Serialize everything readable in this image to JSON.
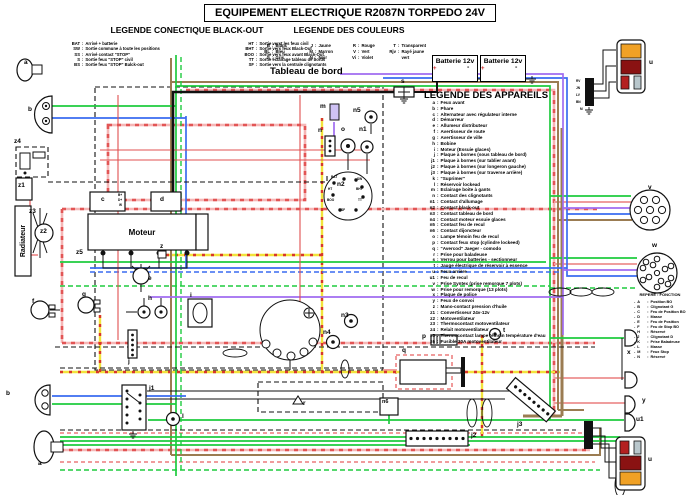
{
  "title": "EQUIPEMENT ELECTRIQUE R2087N TORPEDO 24V",
  "ui": {
    "sep": ":",
    "bullet": "-"
  },
  "colors": {
    "green": "#1ecb3e",
    "pink": "#f2a0a0",
    "red": "#e25555",
    "blue": "#3a6cf0",
    "yellow": "#f2e33c",
    "brown": "#9b7c52",
    "violet": "#a06cf0",
    "black": "#111111",
    "orange": "#f0a125",
    "dark_red": "#8a1212"
  },
  "legend_connectique": {
    "title": "LEGENDE CONECTIQUE BLACK-OUT",
    "col1": [
      {
        "c": "BAT",
        "d": "Arrivé + batterie"
      },
      {
        "c": "SW",
        "d": "Sortie commune à toute les positions"
      },
      {
        "c": "SS",
        "d": "Arrivé contact \"STOP\""
      },
      {
        "c": "S",
        "d": "Sortie feux \"STOP\" civil"
      },
      {
        "c": "BS",
        "d": "Sortie feux \"STOP\" Balck-out"
      }
    ],
    "col2": [
      {
        "c": "HT",
        "d": "Sortie verst les feux civil"
      },
      {
        "c": "BHT",
        "d": "Sortie vers feux Black-Out"
      },
      {
        "c": "BOO",
        "d": "Sortie vers feux avant Black-Out"
      },
      {
        "c": "TT",
        "d": "Sortie éclairage tableau de bords"
      },
      {
        "c": "SF",
        "d": "Sortie vers la centrale clignotants"
      }
    ]
  },
  "legend_couleurs": {
    "title": "LEGENDE DES COULEURS",
    "col1": [
      {
        "c": "B",
        "d": "Blanc"
      },
      {
        "c": "BL",
        "d": "Bleu"
      },
      {
        "c": "G",
        "d": "Gris"
      }
    ],
    "col2": [
      {
        "c": "J",
        "d": "Jaune"
      },
      {
        "c": "M",
        "d": "Marron"
      },
      {
        "c": "N",
        "d": "Noir"
      }
    ],
    "col3": [
      {
        "c": "R",
        "d": "Rouge"
      },
      {
        "c": "V",
        "d": "Vert"
      },
      {
        "c": "Vi",
        "d": "Violet"
      }
    ],
    "col4": [
      {
        "c": "T",
        "d": "Transparent"
      },
      {
        "c": "Rjv",
        "d": "Rayé jaune vert"
      }
    ]
  },
  "legend_appareils": {
    "title": "LEGENDE DES APPAREILS",
    "items": [
      {
        "c": "a",
        "d": "Feux avant"
      },
      {
        "c": "b",
        "d": "Phare"
      },
      {
        "c": "c",
        "d": "Alternateur avec régulateur interne"
      },
      {
        "c": "d",
        "d": "Démarreur"
      },
      {
        "c": "e",
        "d": "Allumeur distributeur"
      },
      {
        "c": "f",
        "d": "Avertisseur de route"
      },
      {
        "c": "g",
        "d": "Avertisseur de ville"
      },
      {
        "c": "h",
        "d": "Bobine"
      },
      {
        "c": "i",
        "d": "Moteur (Essuie glaces)"
      },
      {
        "c": "j",
        "d": "Plaque à bornes (sous tableau de bord)"
      },
      {
        "c": "j1",
        "d": "Plaque à bornes (sur tablier avant)"
      },
      {
        "c": "j2",
        "d": "Plaque à bornes (sur longeron gauche)"
      },
      {
        "c": "j3",
        "d": "Plaque à bornes (sur traverse arrière)"
      },
      {
        "c": "k",
        "d": "\"Suprimer\""
      },
      {
        "c": "l",
        "d": "Réservoir lockead"
      },
      {
        "c": "m",
        "d": "Eclairage boite à gants"
      },
      {
        "c": "n",
        "d": "Contact des clignotants"
      },
      {
        "c": "n1",
        "d": "Contact d'allumage"
      },
      {
        "c": "n2",
        "d": "Contact black-out"
      },
      {
        "c": "n3",
        "d": "Contact tableau de bord"
      },
      {
        "c": "n4",
        "d": "Contact moteur essuie glaces"
      },
      {
        "c": "n5",
        "d": "Contact feu de recul"
      },
      {
        "c": "n6",
        "d": "Contact dijoncteur"
      },
      {
        "c": "o",
        "d": "Lampe témoin feu de recul"
      },
      {
        "c": "p",
        "d": "Contact feux stop (cylindre lockeed)"
      },
      {
        "c": "q",
        "d": "\"Avercod\" Jaeger - comodo"
      },
      {
        "c": "r",
        "d": "Prise pour baladeuse"
      },
      {
        "c": "s",
        "d": "Verrou pour batteries - sectionneur"
      },
      {
        "c": "t",
        "d": "Jauge électrique de réservoir à essence"
      },
      {
        "c": "u",
        "d": "Feux arrière"
      },
      {
        "c": "u1",
        "d": "Feu de recul"
      },
      {
        "c": "v",
        "d": "Prise Syntex (prise remorque 7 plots)"
      },
      {
        "c": "w",
        "d": "Prise pour remorque (13 plots)"
      },
      {
        "c": "x",
        "d": "Plaque de police"
      },
      {
        "c": "y",
        "d": "Feux de convoi"
      },
      {
        "c": "z",
        "d": "Mano-contact pression d'huile"
      },
      {
        "c": "z1",
        "d": "Convertisseur 24v-12v"
      },
      {
        "c": "z2",
        "d": "Motoventilateur"
      },
      {
        "c": "z3",
        "d": "Thermocontact motoventilateur"
      },
      {
        "c": "z4",
        "d": "Relait motoventilateur"
      },
      {
        "c": "z5",
        "d": "Thermocontact lampe témoin température d'eau"
      },
      {
        "c": "z6",
        "d": "Fusible 30A motoventilateur"
      }
    ]
  },
  "repere": {
    "title": "REPERE : FONCTION",
    "items": [
      {
        "c": "A",
        "d": "Position BO"
      },
      {
        "c": "B",
        "d": "Clignotant G"
      },
      {
        "c": "C",
        "d": "Feu de Position BO"
      },
      {
        "c": "D",
        "d": "Masse"
      },
      {
        "c": "E",
        "d": "Feu de Position"
      },
      {
        "c": "F",
        "d": "Feu de Stop BO"
      },
      {
        "c": "H",
        "d": "Réservé"
      },
      {
        "c": "J",
        "d": "Clignotant D"
      },
      {
        "c": "K",
        "d": "Prise Baladeuse"
      },
      {
        "c": "L",
        "d": "Masse"
      },
      {
        "c": "M",
        "d": "Feux Stop"
      },
      {
        "c": "N",
        "d": "Réservé"
      }
    ]
  },
  "boxes": {
    "tableau": "Tableau de bord",
    "moteur": "Moteur",
    "radiateur": "Radiateur"
  },
  "batteries": {
    "b1": "Batterie 12v",
    "b2": "Batterie 12v"
  },
  "canvas_labels": [
    {
      "t": "a",
      "x": 24,
      "y": 60
    },
    {
      "t": "b",
      "x": 28,
      "y": 107
    },
    {
      "t": "z4",
      "x": 14,
      "y": 139
    },
    {
      "t": "z1",
      "x": 18,
      "y": 183
    },
    {
      "t": "z3",
      "x": 29,
      "y": 209
    },
    {
      "t": "z2",
      "x": 40,
      "y": 229
    },
    {
      "t": "z5",
      "x": 76,
      "y": 250
    },
    {
      "t": "c",
      "x": 101,
      "y": 197
    },
    {
      "t": "d",
      "x": 160,
      "y": 197
    },
    {
      "t": "z",
      "x": 160,
      "y": 244
    },
    {
      "t": "e",
      "x": 148,
      "y": 276
    },
    {
      "t": "f",
      "x": 32,
      "y": 299
    },
    {
      "t": "g",
      "x": 82,
      "y": 292
    },
    {
      "t": "h",
      "x": 148,
      "y": 296
    },
    {
      "t": "j",
      "x": 128,
      "y": 359
    },
    {
      "t": "i",
      "x": 190,
      "y": 293
    },
    {
      "t": "b",
      "x": 6,
      "y": 391
    },
    {
      "t": "j1",
      "x": 149,
      "y": 386
    },
    {
      "t": "l",
      "x": 182,
      "y": 414
    },
    {
      "t": "a",
      "x": 38,
      "y": 461
    },
    {
      "t": "m",
      "x": 320,
      "y": 104
    },
    {
      "t": "n5",
      "x": 353,
      "y": 108
    },
    {
      "t": "n",
      "x": 318,
      "y": 128
    },
    {
      "t": "o",
      "x": 341,
      "y": 127
    },
    {
      "t": "n1",
      "x": 359,
      "y": 127
    },
    {
      "t": "n2",
      "x": 337,
      "y": 182
    },
    {
      "t": "n3",
      "x": 341,
      "y": 313
    },
    {
      "t": "n4",
      "x": 323,
      "y": 330
    },
    {
      "t": "r",
      "x": 303,
      "y": 401
    },
    {
      "t": "n6",
      "x": 382,
      "y": 400,
      "cls": "sm"
    },
    {
      "t": "q",
      "x": 402,
      "y": 348
    },
    {
      "t": "p",
      "x": 422,
      "y": 334
    },
    {
      "t": "t",
      "x": 503,
      "y": 328
    },
    {
      "t": "s",
      "x": 401,
      "y": 79
    },
    {
      "t": "j2",
      "x": 471,
      "y": 433
    },
    {
      "t": "j3",
      "x": 517,
      "y": 422
    },
    {
      "t": "u",
      "x": 649,
      "y": 60
    },
    {
      "t": "v",
      "x": 648,
      "y": 185
    },
    {
      "t": "w",
      "x": 652,
      "y": 243
    },
    {
      "t": "x",
      "x": 627,
      "y": 350
    },
    {
      "t": "y",
      "x": 642,
      "y": 398
    },
    {
      "t": "u1",
      "x": 636,
      "y": 417
    },
    {
      "t": "u",
      "x": 648,
      "y": 457
    },
    {
      "t": "+",
      "x": 433,
      "y": 66,
      "cls": "plus"
    },
    {
      "t": "-",
      "x": 467,
      "y": 64,
      "cls": "minus"
    },
    {
      "t": "+",
      "x": 481,
      "y": 66,
      "cls": "plus"
    },
    {
      "t": "-",
      "x": 515,
      "y": 64,
      "cls": "minus"
    },
    {
      "t": "BAT",
      "x": 331,
      "y": 176,
      "cls": "tiny"
    },
    {
      "t": "SW",
      "x": 357,
      "y": 178,
      "cls": "tiny"
    },
    {
      "t": "HT",
      "x": 328,
      "y": 188,
      "cls": "tiny"
    },
    {
      "t": "BHT",
      "x": 356,
      "y": 188,
      "cls": "tiny"
    },
    {
      "t": "BOO",
      "x": 327,
      "y": 199,
      "cls": "tiny"
    },
    {
      "t": "TT",
      "x": 358,
      "y": 199,
      "cls": "tiny"
    },
    {
      "t": "SF",
      "x": 341,
      "y": 209,
      "cls": "tiny"
    },
    {
      "t": "B+",
      "x": 118,
      "y": 194,
      "cls": "tiny"
    },
    {
      "t": "D+",
      "x": 118,
      "y": 199,
      "cls": "tiny"
    },
    {
      "t": "W",
      "x": 119,
      "y": 204,
      "cls": "tiny"
    },
    {
      "t": "RV",
      "x": 576,
      "y": 80,
      "cls": "tiny"
    },
    {
      "t": "JN",
      "x": 576,
      "y": 87,
      "cls": "tiny"
    },
    {
      "t": "LV",
      "x": 576,
      "y": 94,
      "cls": "tiny"
    },
    {
      "t": "BN",
      "x": 576,
      "y": 101,
      "cls": "tiny"
    },
    {
      "t": "M",
      "x": 580,
      "y": 108,
      "cls": "tiny"
    }
  ]
}
